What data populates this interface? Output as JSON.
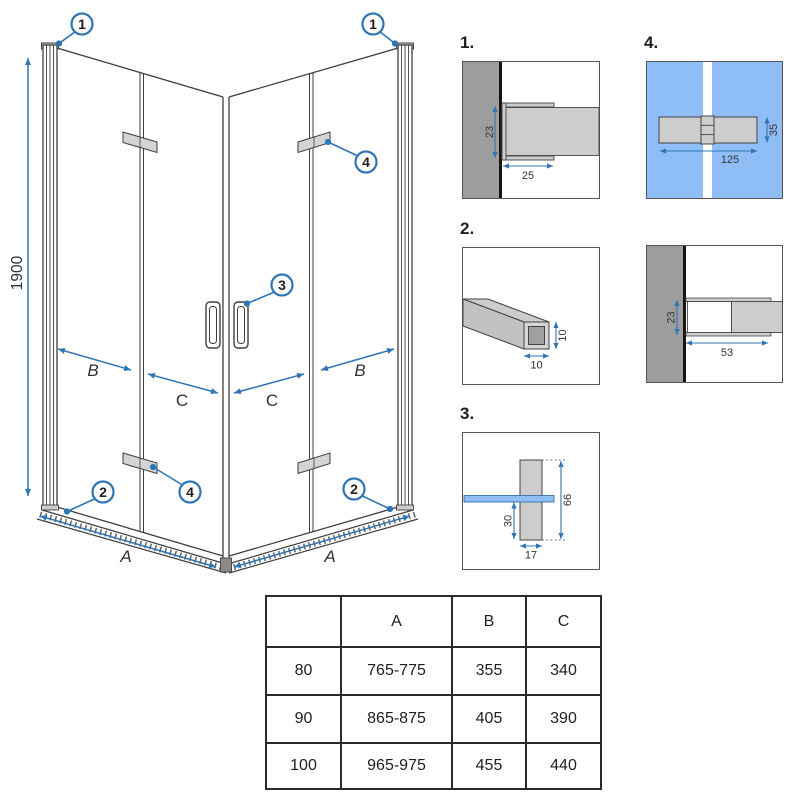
{
  "colors": {
    "accent_blue": "#2e75b6",
    "glass_blue": "#8fbdf5",
    "wall_grey": "#9d9d9d",
    "metal_grey": "#cdcdcd",
    "line_dark": "#3f3f3f"
  },
  "main_drawing": {
    "description": "corner shower enclosure with bi-fold doors, isometric view",
    "dim_height": "1900",
    "dim_a": "A",
    "dim_b": "B",
    "dim_c": "C",
    "callout_wall_profile": "1",
    "callout_bottom_rail": "2",
    "callout_handle": "3",
    "callout_hinge": "4"
  },
  "details": {
    "d1": {
      "label": "1.",
      "dim_height": "23",
      "dim_depth": "25"
    },
    "d2": {
      "label": "2.",
      "dim_w": "10",
      "dim_h": "10"
    },
    "d3": {
      "label": "3.",
      "dim_lower": "30",
      "dim_total": "66",
      "dim_width": "17"
    },
    "d4": {
      "label": "4.",
      "dim_height": "35",
      "dim_length": "125"
    },
    "d5": {
      "dim_height": "23",
      "dim_length": "53"
    }
  },
  "size_table": {
    "headers": [
      "",
      "A",
      "B",
      "C"
    ],
    "rows": [
      [
        "80",
        "765-775",
        "355",
        "340"
      ],
      [
        "90",
        "865-875",
        "405",
        "390"
      ],
      [
        "100",
        "965-975",
        "455",
        "440"
      ]
    ]
  }
}
